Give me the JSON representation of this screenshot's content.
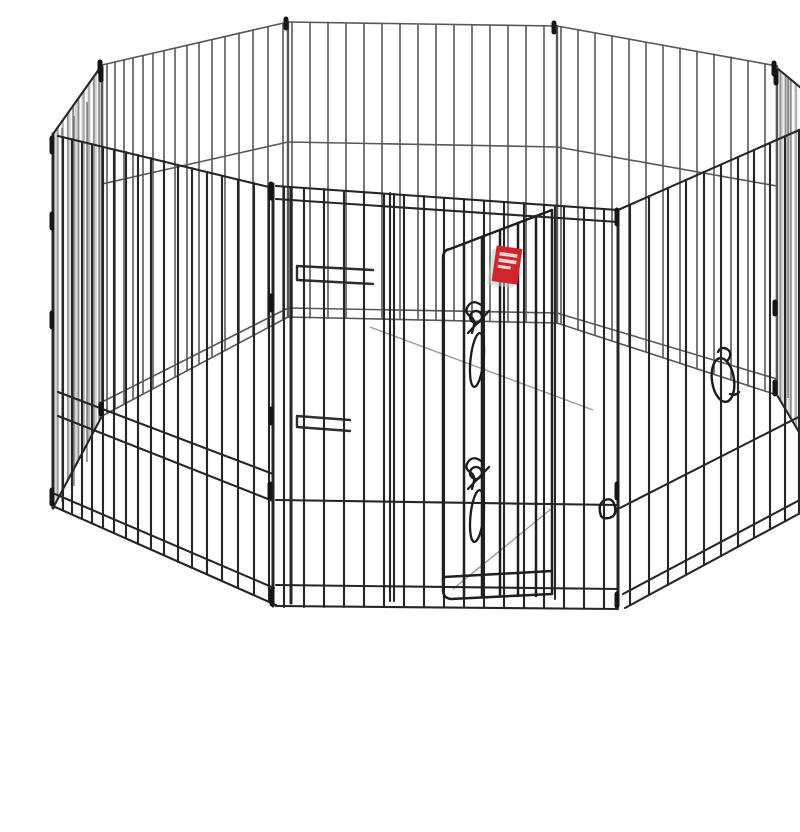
{
  "meta": {
    "type": "product-photo",
    "subject": "Octagonal 8-panel black wire pet exercise playpen with step-through door"
  },
  "scene": {
    "alt": "Octagonal black wire pet exercise pen made of eight hinged mesh panels, with a front access door secured by two spring slide-bolt latches, a small red brand tag on the door, a hanging metal snap ring inside, and wire clamp hinges at each panel joint, photographed on a plain white background",
    "caption": "8-panel wire exercise pen with door",
    "elements": [
      {
        "name": "back-center-panel",
        "desc": "far wire panel seen through the pen"
      },
      {
        "name": "back-left-panel",
        "desc": "far angled wire panel"
      },
      {
        "name": "back-right-panel",
        "desc": "far angled wire panel"
      },
      {
        "name": "left-side-panel",
        "desc": "edge-on side panel, dense foreshortened wires"
      },
      {
        "name": "right-side-panel",
        "desc": "edge-on side panel, dense foreshortened wires"
      },
      {
        "name": "front-left-panel",
        "desc": "near wire panel"
      },
      {
        "name": "front-center-panel",
        "desc": "near wire panel containing the door"
      },
      {
        "name": "front-right-panel",
        "desc": "near wire panel"
      },
      {
        "name": "door",
        "desc": "hinged wire door, slightly ajar"
      },
      {
        "name": "latch-upper",
        "desc": "spring slide-bolt latch with oval pull"
      },
      {
        "name": "latch-lower",
        "desc": "spring slide-bolt latch with oval pull"
      },
      {
        "name": "brand-tag",
        "desc": "small red tag with illegible white text lines"
      },
      {
        "name": "ring-clip",
        "desc": "metal snap ring hanging on an inner rail"
      },
      {
        "name": "clamp-bars",
        "desc": "short double-wire clamp brackets seen through the pen"
      },
      {
        "name": "junction-clamps",
        "desc": "dark hinge clamps at panel corners and posts"
      },
      {
        "name": "floor-shadows",
        "desc": "faint diagonal wire shadows on the ground"
      }
    ],
    "panel_count": 8,
    "latch_count": 2
  },
  "colors": {
    "background": "#ffffff",
    "wire_near": "#262626",
    "wire_far": "#585858",
    "door_wire": "#1f1f1f",
    "wire_dense": "#8d8d8d",
    "wire_dense_light": "#c2c2c2",
    "clamp": "#151515",
    "clamp_bar": "#2e2e2e",
    "shadow_line": "#9a9a9a",
    "latch": "#1c1c1c",
    "tag_red": "#d0262b",
    "tag_stripe": "#f2d8d5",
    "tag_shadow": "#c4c4c4"
  }
}
